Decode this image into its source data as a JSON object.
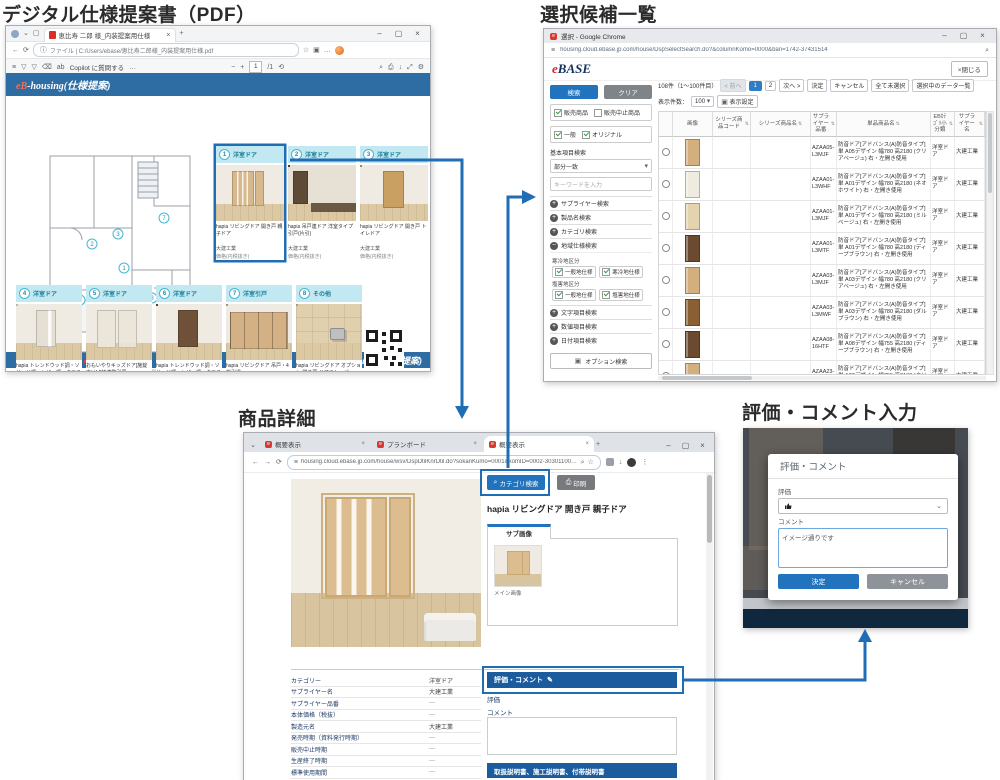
{
  "icons": {
    "back": "←",
    "forward": "→",
    "refresh": "⟳",
    "menu": "≡",
    "search": "⌕",
    "star": "☆",
    "more-h": "…",
    "more-v": "⋮",
    "close": "×",
    "min": "–",
    "max": "▢",
    "plus": "+",
    "minus": "−",
    "caret": "▾",
    "chevron": "⌄",
    "print": "⎙",
    "pencil": "✎",
    "acc-plus": "+",
    "acc-minus": "−",
    "ext": "▣",
    "gear": "⚙",
    "expand": "⤢",
    "rotate": "⟲",
    "download": "↓",
    "draw": "▽",
    "erase": "⌫",
    "read": "ab",
    "info": "ⓘ",
    "sort": "⇅",
    "page-sep": "/1",
    "tab-plus": "+"
  },
  "headings": {
    "pdf": "デジタル仕様提案書（PDF）",
    "selection": "選択候補一覧",
    "detail": "商品詳細",
    "rating": "評価・コメント入力"
  },
  "pdf": {
    "tab_title": "恵比寿 二郎 様_内装提案用仕様",
    "url": "ファイル | C:/Users/ebase/恵比寿二郎様_内装提案用仕様.pdf",
    "copilot": "Copilot に質問する",
    "page_num": "1",
    "page_total": "/1",
    "doc_logo_e": "eB",
    "doc_logo_rest": "-housing(仕様提案)",
    "cards": [
      {
        "num": "1",
        "tag": "洋室ドア",
        "name": "hapia リビングドア 開き戸 親子ドア",
        "maker": "大建工業",
        "price": "価格(内税抜き)",
        "style": "double",
        "door": "#d8b98e"
      },
      {
        "num": "2",
        "tag": "洋室ドア",
        "name": "hapia 吊戸連ドア 洋室タイプ 引戸(片引)",
        "maker": "大建工業",
        "price": "価格(内税抜き)",
        "style": "dark-room",
        "door": "#5f4a38"
      },
      {
        "num": "3",
        "tag": "洋室ドア",
        "name": "hapia リビングドア 開き戸 トイレドア",
        "maker": "大建工業",
        "price": "価格(内税抜き)",
        "style": "single",
        "door": "#c9a061"
      },
      {
        "num": "4",
        "tag": "洋室ドア",
        "name": "hapia トレンドウッド調・ソリッド調・レザー調・クロス調 リビングドア 開き戸 親子ドア",
        "maker": "大建工業",
        "price": "価格(内税抜き)",
        "style": "single-glass",
        "door": "#e6e0d4"
      },
      {
        "num": "5",
        "tag": "洋室ドア",
        "name": "おもいやりキッズドア[施錠向け] 2枚連動引戸",
        "maker": "大建工業",
        "price": "価格(内税設定)",
        "style": "sliding",
        "door": "#ece6da"
      },
      {
        "num": "6",
        "tag": "洋室ドア",
        "name": "hapia トレンドウッド調・ソリッド調・レザー調・クロス調 リビングドア 開き戸 トイレドア",
        "maker": "大建工業",
        "price": "価格(内税抜き)",
        "style": "single",
        "door": "#6e5138"
      },
      {
        "num": "7",
        "tag": "洋室引戸",
        "name": "hapia リビングドア 吊戸・4枚引違",
        "maker": "大建工業",
        "price": "価格(内税設定)",
        "style": "four-panel",
        "door": "#d3b184"
      },
      {
        "num": "8",
        "tag": "その他",
        "name": "hapia リビングドア オプション 開き戸 ドアストッパー",
        "maker": "大建工業",
        "price": "価格(内税設定)",
        "style": "stopper",
        "door": "#d9bf96"
      }
    ]
  },
  "selection": {
    "window_title": "選択 - Google Chrome",
    "url": "housing.cloud.ebase.jp.com/house/DspSelectSearch.do?&columnKomo=0000&ban=1742-37431514",
    "logo_e": "e",
    "logo_rest": "BASE",
    "close_btn": "×閉じる",
    "sidebar": {
      "search_btn": "検索",
      "clear_btn": "クリア",
      "cb_sale": "販売商品",
      "cb_stop": "販売中止商品",
      "cb_general": "一般",
      "cb_original": "オリジナル",
      "basic_label": "基本項目検索",
      "match_select": "部分一致",
      "keyword_placeholder": "キーワードを入力",
      "acc_supplier": "サプライヤー検索",
      "acc_product": "製品名検索",
      "acc_category": "カテゴリ検索",
      "acc_region": "地域仕様検索",
      "cold_label": "寒冷地区分",
      "cold_general": "一般地仕様",
      "cold_cold": "寒冷地仕様",
      "salt_label": "塩害地区分",
      "salt_general": "一般地仕様",
      "salt_salt": "塩害地仕様",
      "acc_text": "文字項目検索",
      "acc_number": "数値項目検索",
      "acc_date": "日付項目検索",
      "option_btn": "オプション検索"
    },
    "controls": {
      "count": "108件（1～100件目）",
      "prev": "< 前へ",
      "page1": "1",
      "page2": "2",
      "next": "次へ >",
      "decide": "決定",
      "cancel": "キャンセル",
      "unselect_all": "全て未選択",
      "selected_list": "選択中のデータ一覧",
      "per_page_label": "表示件数：",
      "per_page_value": "100",
      "display_btn": "表示設定"
    },
    "table": {
      "headers": [
        "画像",
        "シリーズ商品コード",
        "シリーズ商品名",
        "サプライヤー品番",
        "単品商品名",
        "EBｶﾃｺﾞﾘ小分類",
        "サプライヤー名"
      ],
      "rows": [
        {
          "hinban": "AZAA05-L3MJF",
          "name": "防音ドア[アドバンス(A)防音タイプ] 単 A05デザイン 幅780 高2180 (クリアベージュ) 右・左開き使用",
          "category": "洋室ドア",
          "maker": "大建工業",
          "door": "#d3af7d"
        },
        {
          "hinban": "AZAA01-L3WHF",
          "name": "防音ドア[アドバンス(A)防音タイプ] 単 A01デザイン 幅780 高2180 (ネオホワイト) 右・左開き使用",
          "category": "洋室ドア",
          "maker": "大建工業",
          "door": "#efebe1"
        },
        {
          "hinban": "AZAA01-L3MJF",
          "name": "防音ドア[アドバンス(A)防音タイプ] 単 A01デザイン 幅780 高2180 (ミルベージュ) 右・左開き使用",
          "category": "洋室ドア",
          "maker": "大建工業",
          "door": "#e3d3ae"
        },
        {
          "hinban": "AZAA01-L3MTF",
          "name": "防音ドア[アドバンス(A)防音タイプ] 単 A01デザイン 幅780 高2180 (ディープブラウン) 右・左開き使用",
          "category": "洋室ドア",
          "maker": "大建工業",
          "door": "#6b4a2f"
        },
        {
          "hinban": "AZAA03-L3MJF",
          "name": "防音ドア[アドバンス(A)防音タイプ] 単 A03デザイン 幅780 高2180 (クリアベージュ) 右・左開き使用",
          "category": "洋室ドア",
          "maker": "大建工業",
          "door": "#d3af7d"
        },
        {
          "hinban": "AZAA03-L3MWF",
          "name": "防音ドア[アドバンス(A)防音タイプ] 単 A03デザイン 幅780 高2180 (ダルブラウン) 右・左開き使用",
          "category": "洋室ドア",
          "maker": "大建工業",
          "door": "#8a5f33"
        },
        {
          "hinban": "AZAA08-16HTF",
          "name": "防音ドア[アドバンス(A)防音タイプ] 単 A08デザイン 幅755 高2180 (ディープブラウン) 右・左開き使用",
          "category": "洋室ドア",
          "maker": "大建工業",
          "door": "#6b4a2f"
        },
        {
          "hinban": "AZAA23-L4MJF",
          "name": "防音ドア[アドバンス(A)防音タイプ] 単 A23デザイン 幅755 高2180 (クリアベージュ) 右・左開き使用",
          "category": "洋室ドア",
          "maker": "大建工業",
          "door": "#d3af7d"
        }
      ]
    }
  },
  "detail": {
    "tabs": [
      "概要表示",
      "プランボード",
      "概要表示"
    ],
    "url": "housing.cloud.ebase.jp.com/house/wsv/DspDtilKnrDtil.do?sokanKumo=0001&komID=0002-30301100&nCust...",
    "category_btn": "カテゴリ検索",
    "print_btn": "印刷",
    "product_title": "hapia リビングドア 開き戸 親子ドア",
    "sub_tab": "サブ画像",
    "thumb_caption": "メイン画像",
    "fields": [
      {
        "label": "カテゴリー",
        "value": "洋室ドア"
      },
      {
        "label": "サプライヤー名",
        "value": "大建工業"
      },
      {
        "label": "サプライヤー品番",
        "value": "—"
      },
      {
        "label": "本体価格（税抜）",
        "value": "—"
      },
      {
        "label": "製造元名",
        "value": "大建工業"
      },
      {
        "label": "発売時期（資料発行時期）",
        "value": "—"
      },
      {
        "label": "販売中止時期",
        "value": "—"
      },
      {
        "label": "生産終了時期",
        "value": "—"
      },
      {
        "label": "標準使用期間",
        "value": "—"
      },
      {
        "label": "サプライヤー保証期間の有無",
        "value": "—"
      }
    ],
    "rating_bar": "評価・コメント",
    "rating_label": "評価",
    "comment_label": "コメント",
    "docs_bar": "取扱説明書、施工説明書、付帯説明書"
  },
  "rating": {
    "dialog_title": "評価・コメント",
    "rating_label": "評価",
    "rating_value_icon": "thumbs-up",
    "comment_label": "コメント",
    "comment_value": "イメージ通りです",
    "ok_btn": "決定",
    "cancel_btn": "キャンセル"
  }
}
